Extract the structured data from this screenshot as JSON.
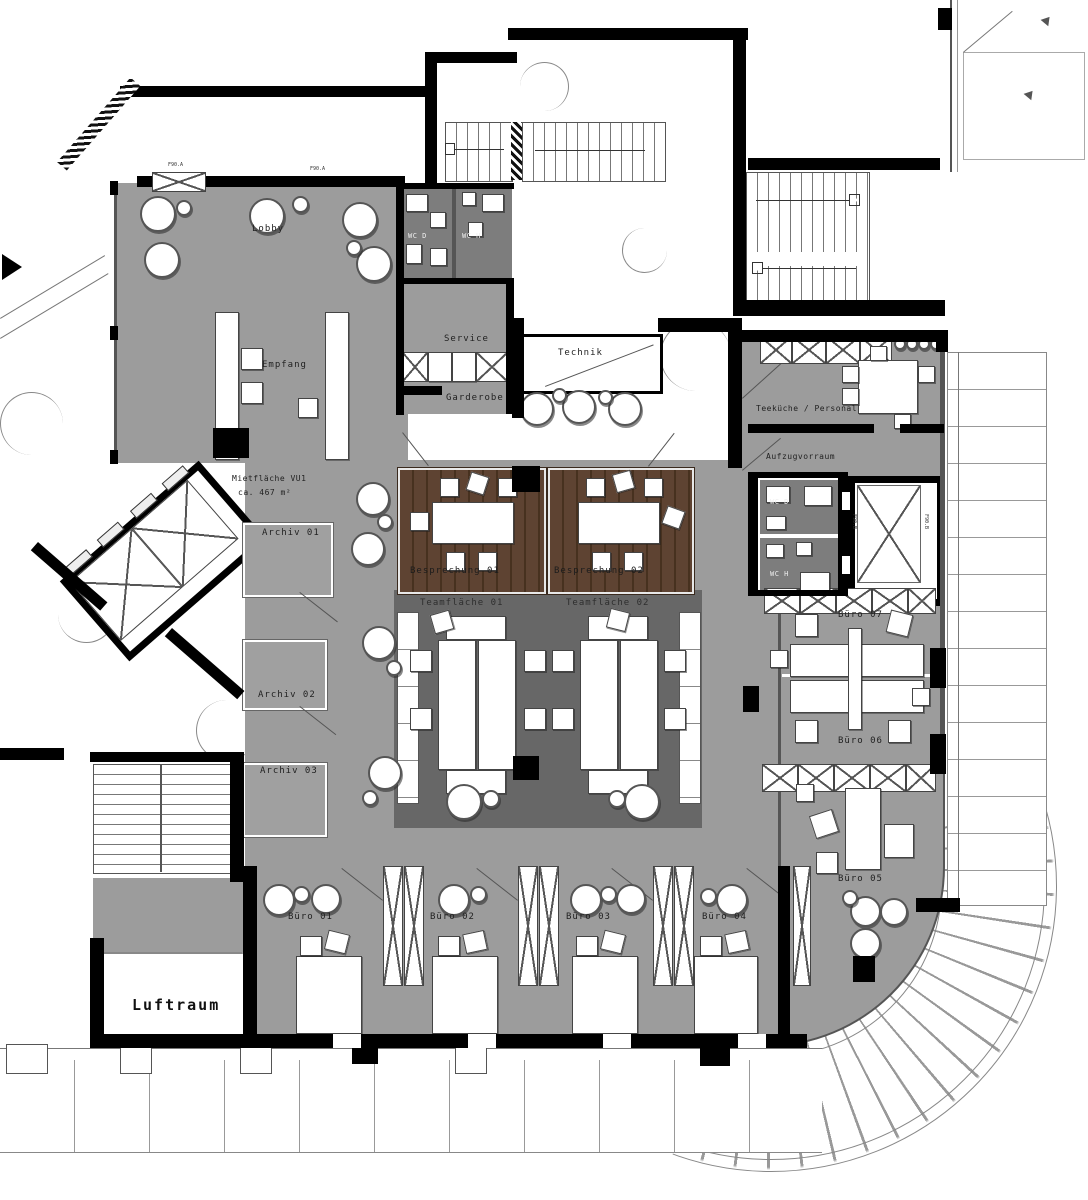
{
  "title": "Grundriss Bürogeschoss – Mietfläche VU1",
  "colors": {
    "floor_gray": "#9c9c9c",
    "dark_room_gray": "#7d7d7d",
    "team_area_gray": "#676767",
    "wood_brown": "#5e4332",
    "wall_black": "#000000",
    "line_gray": "#777777",
    "background": "#ffffff"
  },
  "labels": {
    "lobby": "Lobby",
    "empfang": "Empfang",
    "wc_d_top": "WC D",
    "wc_h_top": "WC H",
    "service": "Service",
    "garderobe": "Garderobe",
    "technik": "Technik",
    "mietflaeche_line1": "Mietfläche VU1",
    "mietflaeche_line2": "ca. 467 m²",
    "archiv_01": "Archiv 01",
    "archiv_02": "Archiv 02",
    "archiv_03": "Archiv 03",
    "besprechung_01": "Besprechung 01",
    "besprechung_02": "Besprechung 02",
    "teamflaeche_01": "Teamfläche 01",
    "teamflaeche_02": "Teamfläche 02",
    "teekueche": "Teeküche / Personal",
    "aufzugvorraum": "Aufzugvorraum",
    "wc_d_right": "WC D",
    "wc_h_right": "WC H",
    "buero_01": "Büro 01",
    "buero_02": "Büro 02",
    "buero_03": "Büro 03",
    "buero_04": "Büro 04",
    "buero_05": "Büro 05",
    "buero_06": "Büro 06",
    "buero_07": "Büro 07",
    "luftraum": "Luftraum",
    "fire_rating_a": "F90.A",
    "fire_rating_b": "F90.B"
  }
}
